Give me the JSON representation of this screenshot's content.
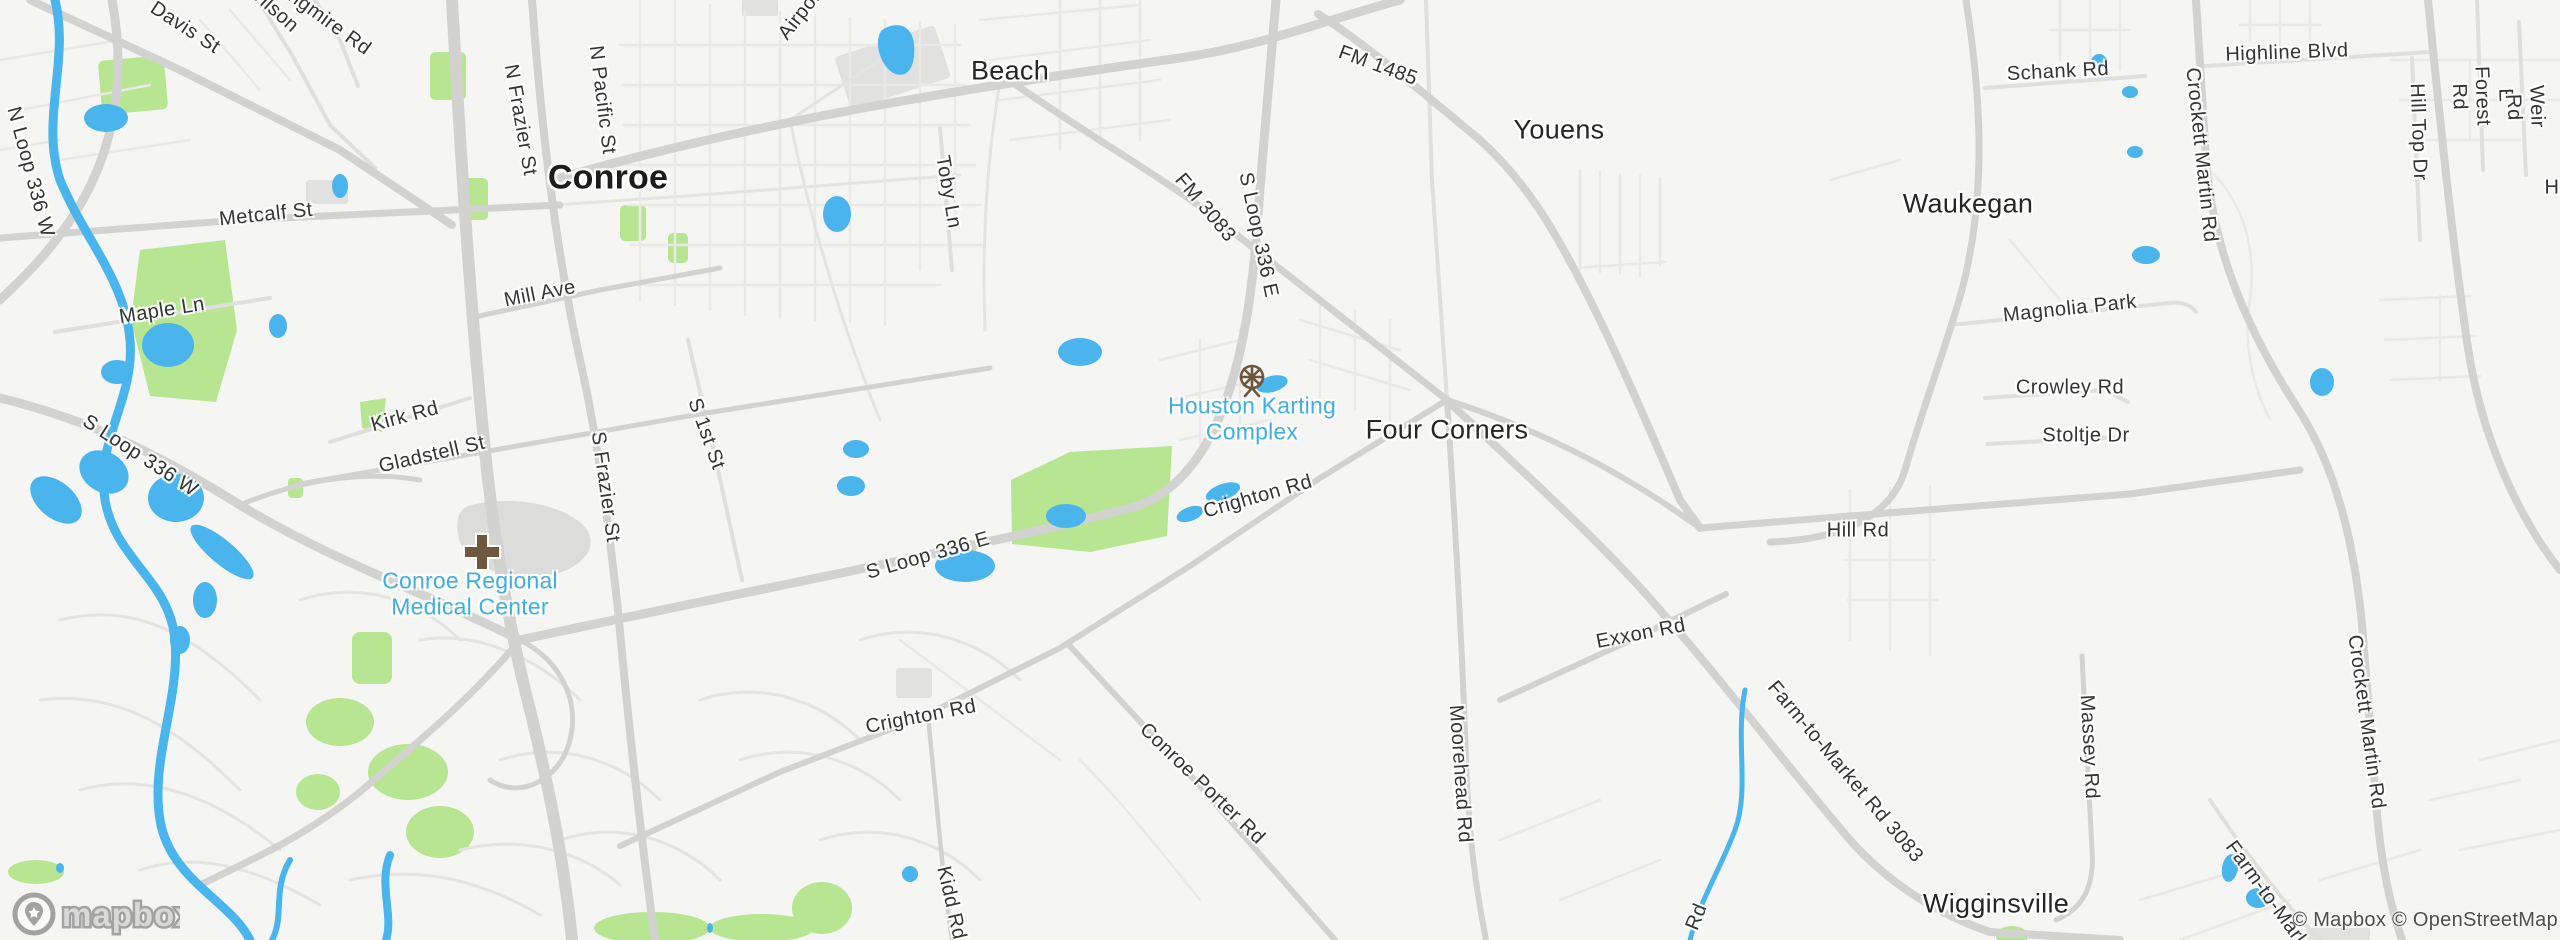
{
  "map": {
    "logo": "mapbox",
    "attribution": "© Mapbox © OpenStreetMap",
    "colors": {
      "land": "#f5f5f3",
      "road_minor": "#e9e9e7",
      "road_medium": "#dfdfdd",
      "road_major": "#d2d2d0",
      "building": "#e1e1df",
      "park": "#b7e591",
      "water": "#4ab5ec",
      "poi_label": "#3fafe0",
      "poi_icon": "#6f573d",
      "town_label": "#262626"
    },
    "labels": [
      {
        "name": "conroe",
        "text": "Conroe",
        "x": 608,
        "y": 178,
        "rot": 0,
        "kind": "city"
      },
      {
        "name": "beach",
        "text": "Beach",
        "x": 1010,
        "y": 71,
        "rot": 0,
        "kind": "town"
      },
      {
        "name": "youens",
        "text": "Youens",
        "x": 1559,
        "y": 130,
        "rot": 0,
        "kind": "town"
      },
      {
        "name": "waukegan",
        "text": "Waukegan",
        "x": 1968,
        "y": 204,
        "rot": 0,
        "kind": "town"
      },
      {
        "name": "four-corners",
        "text": "Four Corners",
        "x": 1447,
        "y": 430,
        "rot": 0,
        "kind": "town"
      },
      {
        "name": "wigginsville",
        "text": "Wigginsville",
        "x": 1996,
        "y": 904,
        "rot": 0,
        "kind": "town"
      },
      {
        "name": "houston-karting-complex",
        "text": "Houston Karting\nComplex",
        "x": 1252,
        "y": 419,
        "rot": 0,
        "kind": "poi"
      },
      {
        "name": "conroe-regional-medical-center",
        "text": "Conroe Regional\nMedical Center",
        "x": 470,
        "y": 594,
        "rot": 0,
        "kind": "poi"
      },
      {
        "name": "davis-st",
        "text": "Davis St",
        "x": 185,
        "y": 28,
        "rot": 33,
        "kind": "road"
      },
      {
        "name": "wilson",
        "text": "Wilson",
        "x": 272,
        "y": 8,
        "rot": 42,
        "kind": "road"
      },
      {
        "name": "longmire-rd",
        "text": "Longmire Rd",
        "x": 320,
        "y": 16,
        "rot": 36,
        "kind": "road"
      },
      {
        "name": "airport-rd",
        "text": "Airport Rd",
        "x": 812,
        "y": 0,
        "rot": -52,
        "kind": "road"
      },
      {
        "name": "n-loop-336-w",
        "text": "N Loop 336 W",
        "x": 30,
        "y": 172,
        "rot": 75,
        "kind": "road"
      },
      {
        "name": "n-frazier-st",
        "text": "N Frazier St",
        "x": 520,
        "y": 120,
        "rot": 80,
        "kind": "road"
      },
      {
        "name": "n-pacific-st",
        "text": "N Pacific St",
        "x": 602,
        "y": 100,
        "rot": 83,
        "kind": "road"
      },
      {
        "name": "metcalf-st",
        "text": "Metcalf St",
        "x": 266,
        "y": 215,
        "rot": -6,
        "kind": "road"
      },
      {
        "name": "maple-ln",
        "text": "Maple Ln",
        "x": 162,
        "y": 311,
        "rot": -9,
        "kind": "road"
      },
      {
        "name": "mill-ave",
        "text": "Mill Ave",
        "x": 540,
        "y": 294,
        "rot": -11,
        "kind": "road"
      },
      {
        "name": "toby-ln",
        "text": "Toby Ln",
        "x": 948,
        "y": 192,
        "rot": 80,
        "kind": "road"
      },
      {
        "name": "fm-1485",
        "text": "FM 1485",
        "x": 1378,
        "y": 66,
        "rot": 20,
        "kind": "road"
      },
      {
        "name": "fm-3083",
        "text": "FM 3083",
        "x": 1205,
        "y": 208,
        "rot": 50,
        "kind": "road"
      },
      {
        "name": "s-loop-336-e-north",
        "text": "S Loop 336 E",
        "x": 1258,
        "y": 235,
        "rot": 78,
        "kind": "road"
      },
      {
        "name": "schank-rd",
        "text": "Schank Rd",
        "x": 2058,
        "y": 72,
        "rot": -3,
        "kind": "road"
      },
      {
        "name": "highline-blvd",
        "text": "Highline Blvd",
        "x": 2287,
        "y": 53,
        "rot": -2,
        "kind": "road"
      },
      {
        "name": "crockett-martin-rd-north",
        "text": "Crockett Martin Rd",
        "x": 2201,
        "y": 155,
        "rot": 84,
        "kind": "road"
      },
      {
        "name": "hill-top-dr",
        "text": "Hill Top Dr",
        "x": 2418,
        "y": 132,
        "rot": 88,
        "kind": "road"
      },
      {
        "name": "e-forest-rd",
        "text": "E Forest Rd",
        "x": 2482,
        "y": 96,
        "rot": 88,
        "kind": "road"
      },
      {
        "name": "weir-rd",
        "text": "Weir Rd",
        "x": 2525,
        "y": 107,
        "rot": 88,
        "kind": "road"
      },
      {
        "name": "h-fragment",
        "text": "H",
        "x": 2552,
        "y": 188,
        "rot": 0,
        "kind": "road"
      },
      {
        "name": "magnolia-park",
        "text": "Magnolia Park",
        "x": 2070,
        "y": 309,
        "rot": -6,
        "kind": "road"
      },
      {
        "name": "crowley-rd",
        "text": "Crowley Rd",
        "x": 2070,
        "y": 388,
        "rot": 0,
        "kind": "road"
      },
      {
        "name": "stoltje-dr",
        "text": "Stoltje Dr",
        "x": 2086,
        "y": 436,
        "rot": 0,
        "kind": "road"
      },
      {
        "name": "kirk-rd",
        "text": "Kirk Rd",
        "x": 405,
        "y": 417,
        "rot": -15,
        "kind": "road"
      },
      {
        "name": "gladstell-st",
        "text": "Gladstell St",
        "x": 432,
        "y": 455,
        "rot": -13,
        "kind": "road"
      },
      {
        "name": "s-frazier-st",
        "text": "S Frazier St",
        "x": 605,
        "y": 487,
        "rot": 82,
        "kind": "road"
      },
      {
        "name": "s-1st-st",
        "text": "S 1st St",
        "x": 706,
        "y": 434,
        "rot": 70,
        "kind": "road"
      },
      {
        "name": "s-loop-336-w",
        "text": "S Loop 336 W",
        "x": 140,
        "y": 456,
        "rot": 33,
        "kind": "road"
      },
      {
        "name": "crighton-rd-east",
        "text": "Crighton Rd",
        "x": 1258,
        "y": 497,
        "rot": -16,
        "kind": "road"
      },
      {
        "name": "s-loop-336-e-south",
        "text": "S Loop 336 E",
        "x": 928,
        "y": 556,
        "rot": -16,
        "kind": "road"
      },
      {
        "name": "hill-rd",
        "text": "Hill Rd",
        "x": 1858,
        "y": 531,
        "rot": 0,
        "kind": "road"
      },
      {
        "name": "exxon-rd",
        "text": "Exxon Rd",
        "x": 1641,
        "y": 634,
        "rot": -11,
        "kind": "road"
      },
      {
        "name": "crighton-rd-west",
        "text": "Crighton Rd",
        "x": 921,
        "y": 717,
        "rot": -11,
        "kind": "road"
      },
      {
        "name": "conroe-porter-rd",
        "text": "Conroe Porter Rd",
        "x": 1202,
        "y": 784,
        "rot": 44,
        "kind": "road"
      },
      {
        "name": "moorehead-rd",
        "text": "Moorehead Rd",
        "x": 1460,
        "y": 774,
        "rot": 86,
        "kind": "road"
      },
      {
        "name": "farm-to-market-rd-3083",
        "text": "Farm-to-Market Rd 3083",
        "x": 1845,
        "y": 772,
        "rot": 50,
        "kind": "road"
      },
      {
        "name": "massey-rd",
        "text": "Massey Rd",
        "x": 2089,
        "y": 747,
        "rot": 87,
        "kind": "road"
      },
      {
        "name": "kidd-rd",
        "text": "Kidd Rd",
        "x": 951,
        "y": 903,
        "rot": 77,
        "kind": "road"
      },
      {
        "name": "rd-fragment",
        "text": "Rd",
        "x": 1697,
        "y": 917,
        "rot": -68,
        "kind": "road"
      },
      {
        "name": "crockett-martin-rd-south",
        "text": "Crockett Martin Rd",
        "x": 2366,
        "y": 722,
        "rot": 82,
        "kind": "road"
      },
      {
        "name": "farm-to-market-south",
        "text": "Farm-to-Market",
        "x": 2272,
        "y": 902,
        "rot": 54,
        "kind": "road"
      }
    ]
  }
}
